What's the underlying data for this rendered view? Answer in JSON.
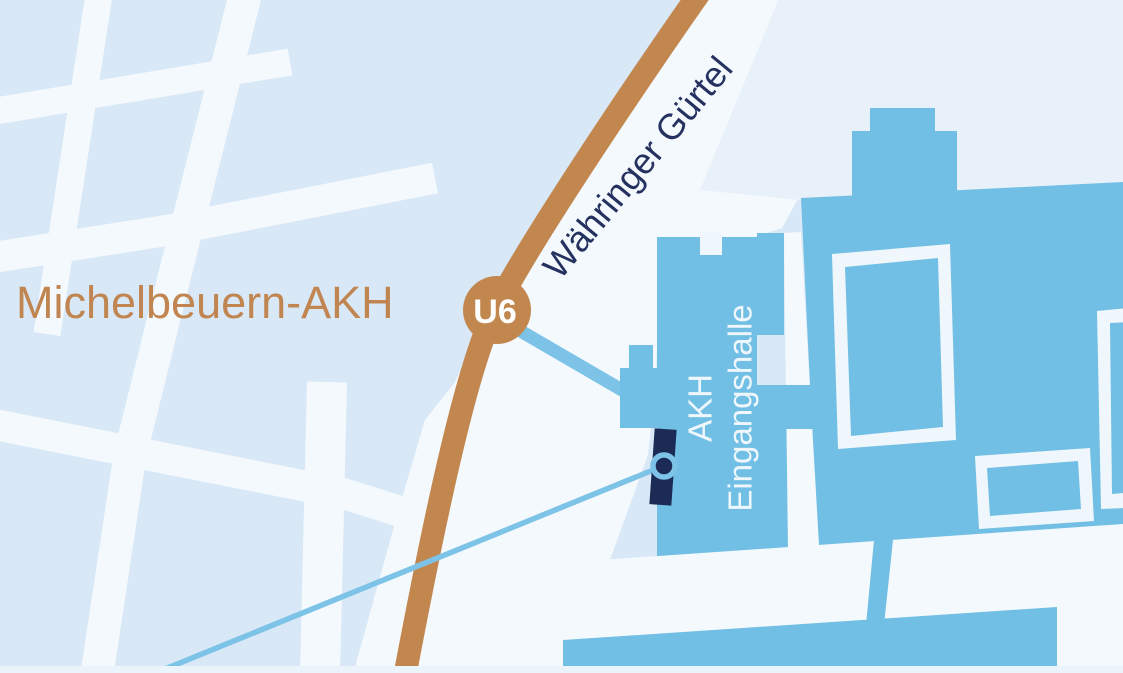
{
  "map": {
    "station": {
      "name": "Michelbeuern-AKH",
      "line_badge": "U6"
    },
    "street_label": "Währinger Gürtel",
    "building_label": {
      "line1": "AKH",
      "line2": "Eingangshalle"
    }
  },
  "colors": {
    "background_blocks": "#d9e8f6",
    "street_light": "#f4f9fd",
    "area_tint": "#e8f1f9",
    "road_brown": "#c2874e",
    "station_label_brown": "#c08551",
    "street_label_navy": "#25315f",
    "building_blue": "#71bfe4",
    "building_label_white": "#eff7fc",
    "badge_text_white": "#ffffff",
    "entrance_marker_navy": "#1b2b55",
    "route_line_blue": "#7cc3e7",
    "bottom_band": "#ecf4fb"
  }
}
